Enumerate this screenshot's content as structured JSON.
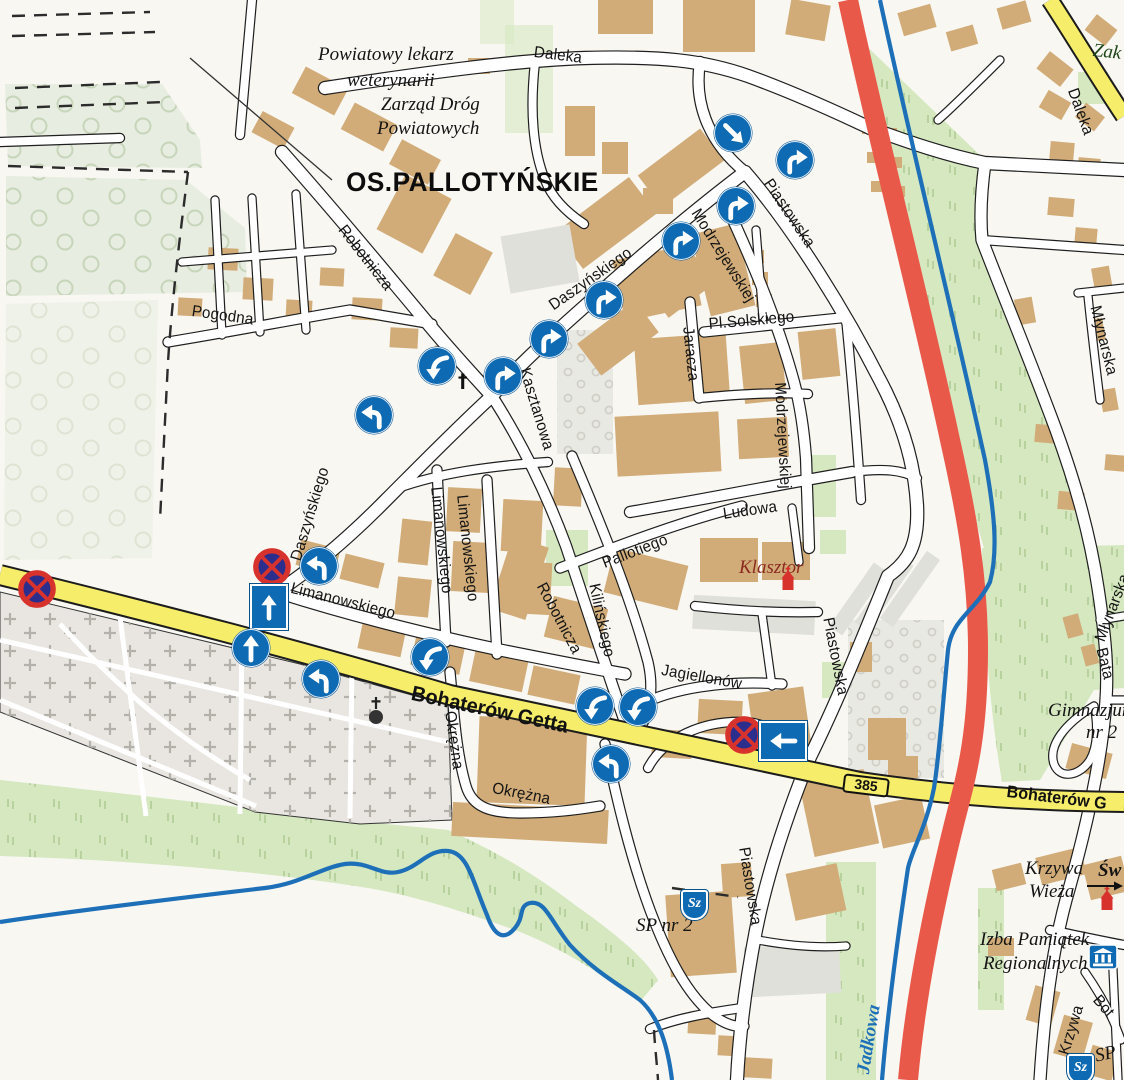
{
  "area_title": "OS.PALLOTYŃSKIE",
  "streets": {
    "daleka": "Daleka",
    "pogodna": "Pogodna",
    "robotnicza": "Robotnicza",
    "daszynskiego": "Daszyńskiego",
    "kasztanowa": "Kasztanowa",
    "piastowska": "Piastowska",
    "modrzejewskiej": "Modrzejewskiej",
    "jaracza": "Jaracza",
    "pl_solskiego": "Pl.Solskiego",
    "ludowa": "Ludowa",
    "pallotiego": "Pallotiego",
    "kilinskiego": "Kilińskiego",
    "limanowskiego": "Limanowskiego",
    "okrezna": "Okrężna",
    "jagiellonow": "Jagiellonów",
    "bohaterow_getta": "Bohaterów Getta",
    "bohaterow_g": "Bohaterów G",
    "mlynarska": "Młynarska",
    "krzywa": "Krzywa",
    "jadkowa": "Jadkowa",
    "partial_zak": "Zak",
    "partial_batalionow": "Bata",
    "partial_bot": "Bot"
  },
  "pois": {
    "vet_line1": "Powiatowy lekarz",
    "vet_line2": "weterynarii",
    "roads_dept_line1": "Zarząd Dróg",
    "roads_dept_line2": "Powiatowych",
    "klasztor": "Klasztor",
    "sp_nr_2": "SP nr 2",
    "sp": "SP",
    "gimnazjum_line1": "Gimnazjum",
    "gimnazjum_line2": "nr 2",
    "krzywa_wieza_line1": "Krzywa",
    "krzywa_wieza_line2": "Wieża",
    "partial_sw": "Św",
    "izba_line1": "Izba Pamiątek",
    "izba_line2": "Regionalnych"
  },
  "badges": {
    "road_number": "385",
    "school": "Sz"
  },
  "symbols": {
    "cross": "†"
  },
  "colors": {
    "main_road_yellow": "#f6ee6a",
    "transit_road_red": "#e9594a",
    "river_blue": "#1d6fb8",
    "sign_blue": "#0d6ab3",
    "no_stopping_navy": "#2b2e8c",
    "no_stopping_red": "#d8322d",
    "building_tan": "#d1ac78",
    "green_area": "#d5e8c0"
  },
  "icon_legend": [
    "no-stopping-sign",
    "one-way-sign",
    "turn-arrow-sign",
    "church-icon",
    "museum-icon",
    "school-shield-icon",
    "cemetery-chapel-icon",
    "direction-arrow-icon"
  ]
}
